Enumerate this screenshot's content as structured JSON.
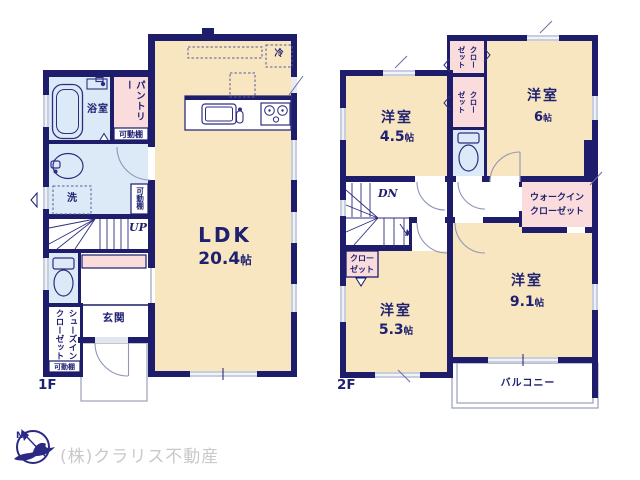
{
  "unit": "帖",
  "colors": {
    "wall": "#1d1d6b",
    "navy_text": "#1e2070",
    "room_beige": "#f8e6c0",
    "wet_blue": "#dce9f6",
    "closet_pink": "#fadcdc",
    "window_gray": "#c9cede",
    "company_gray": "#c9c9c9"
  },
  "floor1": {
    "label": "1F",
    "ldk_name": "LDK",
    "ldk_size": "20.4",
    "bathroom": "浴室",
    "pantry": "パントリー",
    "shelf": "可動棚",
    "laundry": "洗",
    "stairs_dir": "UP",
    "fridge": "冷",
    "entrance": "玄関",
    "shoe_closet": "シューズイン\nクローゼット"
  },
  "floor2": {
    "label": "2F",
    "room_name": "洋室",
    "size_45": "4.5",
    "size_6": "6",
    "size_53": "5.3",
    "size_91": "9.1",
    "closet": "クロー\nゼット",
    "closet_vertical": "クロー\nゼット",
    "walkin_closet": "ウォークイン\nクローゼット",
    "stairs_dir": "DN",
    "balcony": "バルコニー"
  },
  "footer": {
    "company": "(株)クラリス不動産",
    "compass_north": "N"
  }
}
